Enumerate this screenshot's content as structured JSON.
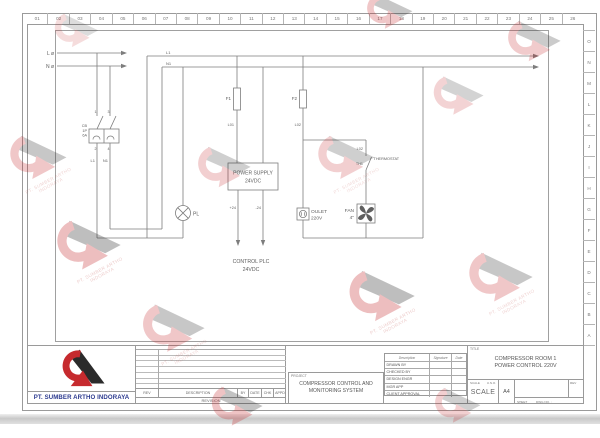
{
  "ruler": {
    "top": [
      "01",
      "02",
      "03",
      "04",
      "05",
      "06",
      "07",
      "08",
      "09",
      "10",
      "11",
      "12",
      "13",
      "14",
      "15",
      "16",
      "17",
      "18",
      "19",
      "20",
      "21",
      "22",
      "23",
      "24",
      "25",
      "26"
    ],
    "right": [
      "O",
      "N",
      "M",
      "L",
      "K",
      "J",
      "I",
      "H",
      "G",
      "F",
      "E",
      "D",
      "C",
      "B",
      "A"
    ]
  },
  "circuit": {
    "feed_l": "L ø",
    "feed_n": "N ø",
    "cb_name": "CB",
    "cb_poles": "1P",
    "cb_rating": "6A",
    "cb_t1": "1",
    "cb_t2": "2",
    "cb_t3": "3",
    "cb_t4": "4",
    "wire_l1": "L1",
    "wire_n1": "N1",
    "bus_l1": "L1",
    "bus_n1": "N1",
    "lamp": "PL",
    "fuse1": "F1",
    "wire_l01": "L01",
    "fuse2": "F2",
    "wire_l02": "L02",
    "psu_line1": "POWER SUPPLY",
    "psu_line2": "24VDC",
    "out_pos": "+24",
    "out_neg": "-24",
    "plc_line1": "CONTROL PLC",
    "plc_line2": "24VDC",
    "outlet_line1": "OULET",
    "outlet_line2": "220V",
    "fan_line1": "FAN",
    "fan_line2": "4\"",
    "th_wire": "L02",
    "th_tag": "TH1",
    "th_label": "THERMOSTAT"
  },
  "titleblock": {
    "company": "PT. SUMBER ARTHO INDORAYA",
    "revision": {
      "headers": [
        "REV",
        "DESCRIPTION",
        "BY",
        "DATE",
        "CHK",
        "APPD"
      ],
      "caption": "REVISION"
    },
    "project": {
      "label": "PROJECT",
      "line1": "COMPRESSOR CONTROL AND",
      "line2": "MONITORING SYSTEM"
    },
    "approval": {
      "headers": [
        "Description",
        "Signature",
        "Date"
      ],
      "rows": [
        "DRAWN BY",
        "CHECKED BY",
        "DESIGN ENGR",
        "MGR APP",
        "CLIENT APPROVAL"
      ]
    },
    "title": {
      "label": "TITLE",
      "line1": "COMPRESSOR ROOM 1",
      "line2": "POWER CONTROL 220V"
    },
    "scale": {
      "label": "SCALE",
      "uno": "U.N.O.",
      "value": "SCALE",
      "size": "A4"
    },
    "rev_label": "REV",
    "sheet_label": "SHEET",
    "dwg_label": "DWG NO. :"
  },
  "watermark": {
    "line1": "PT. SUMBER ARTHO",
    "line2": "INDORAYA"
  }
}
